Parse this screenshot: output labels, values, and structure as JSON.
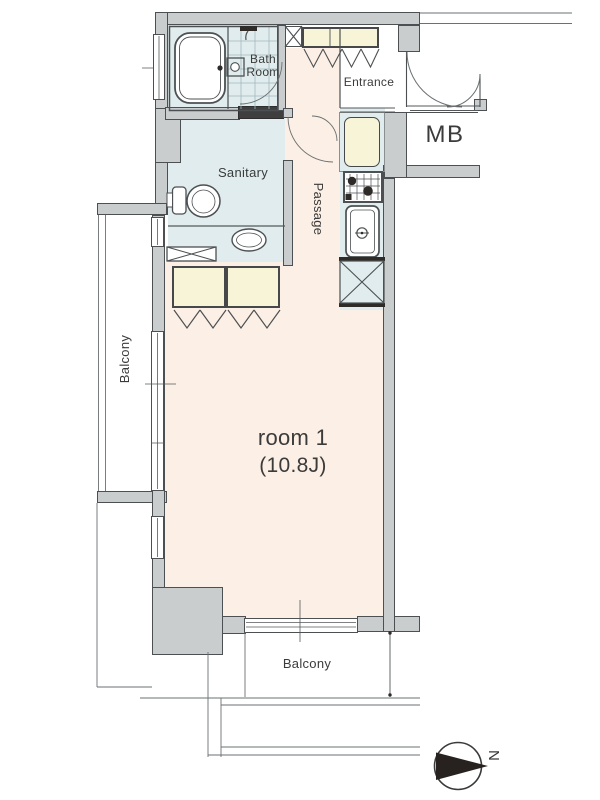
{
  "title": "Apartment floor plan",
  "labels": {
    "bath_room": "Bath\nRoom",
    "entrance": "Entrance",
    "meter_box": "MB",
    "sanitary": "Sanitary",
    "passage": "Passage",
    "room1_line1": "room 1",
    "room1_line2": "(10.8J)",
    "balcony_left": "Balcony",
    "balcony_bottom": "Balcony",
    "compass_north": "N"
  },
  "rooms": [
    {
      "name": "Bath Room"
    },
    {
      "name": "Sanitary"
    },
    {
      "name": "Entrance"
    },
    {
      "name": "Passage"
    },
    {
      "name": "Kitchen"
    },
    {
      "name": "room 1",
      "size": "(10.8J)"
    },
    {
      "name": "Balcony (side)"
    },
    {
      "name": "Balcony (bottom)"
    },
    {
      "name": "MB"
    }
  ],
  "fixtures": [
    "bathtub",
    "shower-head",
    "bath-counter",
    "bath-folding-door",
    "toilet",
    "washbasin",
    "washing-machine-space",
    "linen-closets",
    "shoe-closet",
    "pipe-space",
    "storage-box",
    "gas-stove",
    "kitchen-sink",
    "refrigerator-space",
    "entrance-double-door",
    "interior-door",
    "sanitary-door",
    "sliding-windows",
    "compass-north-arrow"
  ],
  "colors": {
    "wall_fill": "#c9cdce",
    "wall_outline": "#4c5052",
    "wet_area_floor": "#e0eced",
    "room_floor": "#fcefe5",
    "storage_fill": "#f8f4d8",
    "line_thin": "#6b7072",
    "text": "#3b3b3b",
    "dark_fill": "#2e2a28"
  }
}
